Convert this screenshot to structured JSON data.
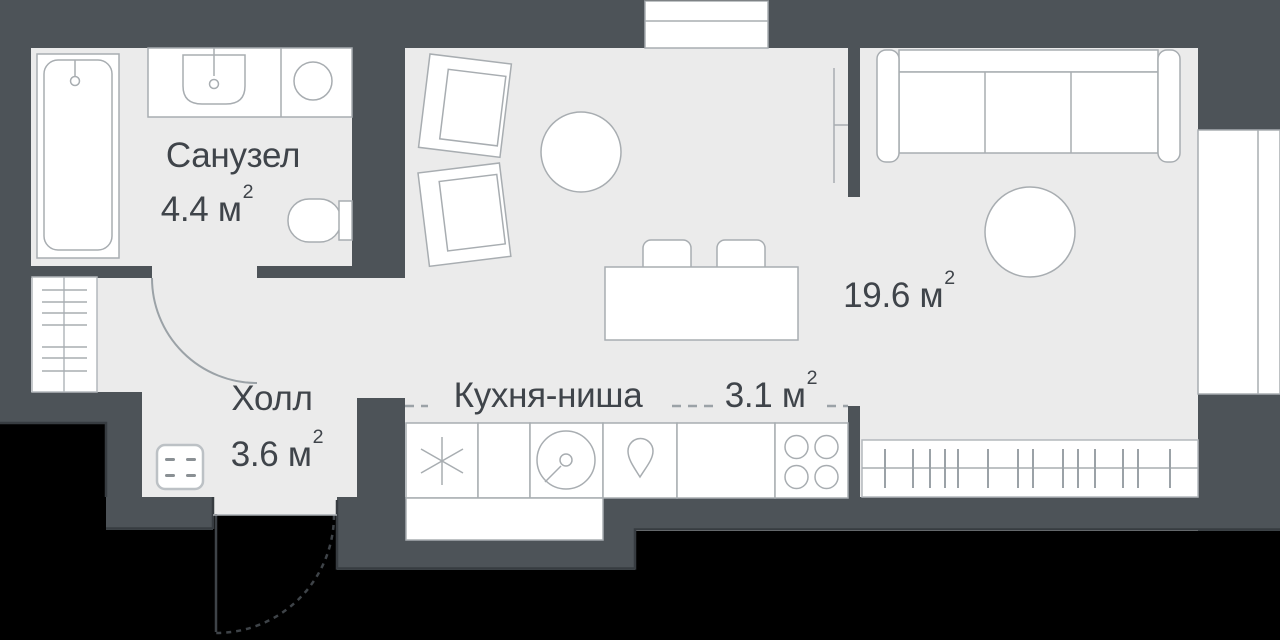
{
  "plan_title": "Studio apartment floor plan",
  "rooms": [
    {
      "key": "bathroom",
      "name": "Санузел",
      "area": "4.4 м",
      "sup": "2"
    },
    {
      "key": "hall",
      "name": "Холл",
      "area": "3.6 м",
      "sup": "2"
    },
    {
      "key": "kitchen",
      "name": "Кухня-ниша",
      "area": "3.1 м",
      "sup": "2"
    },
    {
      "key": "living",
      "name": "",
      "area": "19.6 м",
      "sup": "2"
    }
  ],
  "colors": {
    "background": "#000000",
    "wall": "#4d5358",
    "wall_edge": "#373c41",
    "floor": "#ebebeb",
    "fixture_fill": "#ffffff",
    "fixture_outline": "#a8adb1",
    "text": "#3f444a"
  },
  "fixtures": {
    "bathroom": [
      "bathtub",
      "washbasin",
      "washing-machine",
      "toilet"
    ],
    "hall": [
      "vertical-radiator",
      "electrical-panel",
      "entrance-door-swing",
      "bathroom-door-swing"
    ],
    "kitchen": [
      "fridge",
      "washer",
      "water-drop-sink",
      "counter",
      "hob-4-burners",
      "counter-block"
    ],
    "living": [
      "armchair",
      "armchair",
      "coffee-table",
      "sofa-3-seat",
      "side-table",
      "dining-table",
      "stool",
      "stool",
      "radiator",
      "sliding-partition"
    ],
    "windows": [
      "top-window",
      "right-window"
    ]
  }
}
